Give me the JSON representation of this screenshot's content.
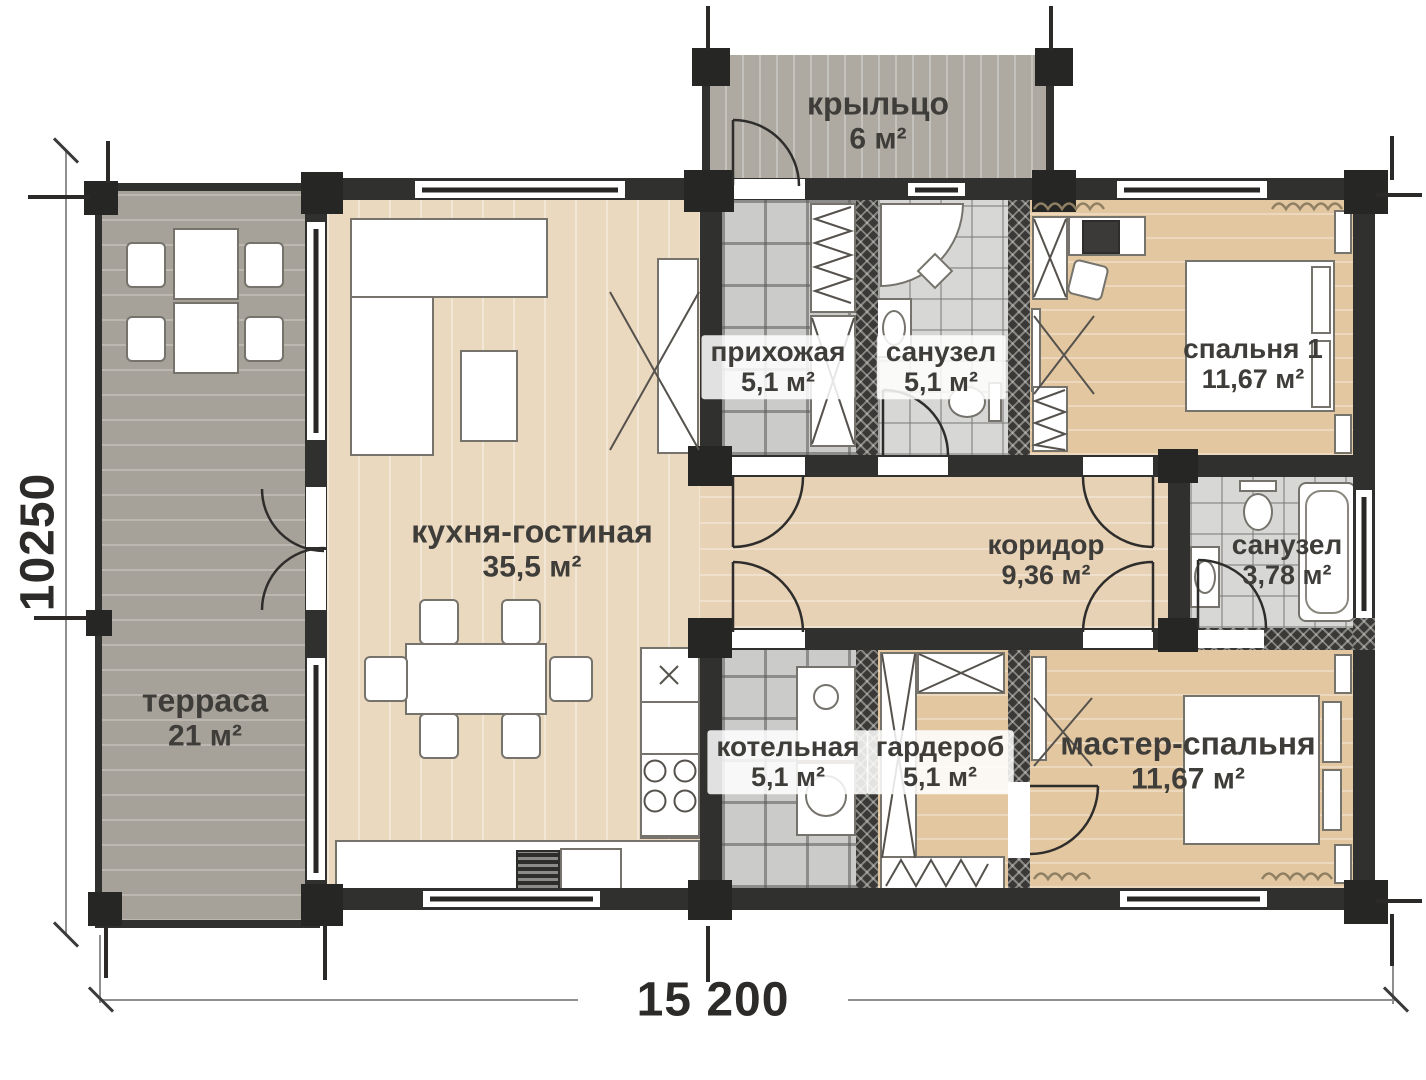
{
  "dimensions": {
    "width_label": "15 200",
    "height_label": "10250"
  },
  "rooms": [
    {
      "id": "terrace",
      "label": "терраса",
      "area": "21 м²"
    },
    {
      "id": "kitchen_living",
      "label": "кухня-гостиная",
      "area": "35,5 м²"
    },
    {
      "id": "porch",
      "label": "крыльцо",
      "area": "6 м²"
    },
    {
      "id": "hallway",
      "label": "прихожая",
      "area": "5,1 м²"
    },
    {
      "id": "bathroom_1",
      "label": "санузел",
      "area": "5,1 м²"
    },
    {
      "id": "bedroom_1",
      "label": "спальня 1",
      "area": "11,67 м²"
    },
    {
      "id": "corridor",
      "label": "коридор",
      "area": "9,36 м²"
    },
    {
      "id": "bathroom_2",
      "label": "санузел",
      "area": "3,78 м²"
    },
    {
      "id": "boiler_room",
      "label": "котельная",
      "area": "5,1 м²"
    },
    {
      "id": "wardrobe",
      "label": "гардероб",
      "area": "5,1 м²"
    },
    {
      "id": "master_bedroom",
      "label": "мастер-спальня",
      "area": "11,67 м²"
    }
  ],
  "colors": {
    "wall": "#30302e",
    "deck": "#a7a299",
    "wood_light": "#ead9bf",
    "wood_tan": "#e3c7a1",
    "tile": "#cbcbc9",
    "text": "#3f3d3a"
  }
}
